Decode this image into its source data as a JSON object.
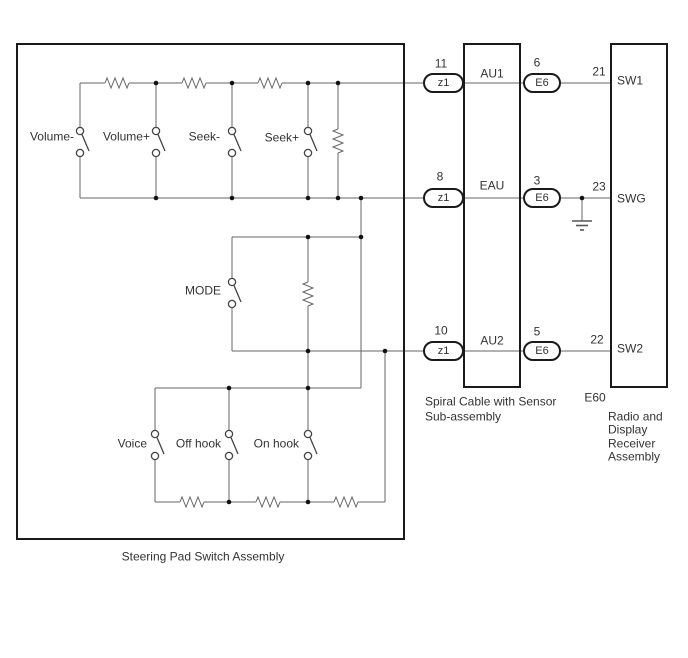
{
  "colors": {
    "background": "#ffffff",
    "wire": "#666666",
    "outline": "#1a1a1a",
    "text": "#333333"
  },
  "steering_pad_assembly": {
    "label": "Steering Pad Switch Assembly",
    "switches": {
      "volume_minus": "Volume-",
      "volume_plus": "Volume+",
      "seek_minus": "Seek-",
      "seek_plus": "Seek+",
      "mode": "MODE",
      "voice": "Voice",
      "off_hook": "Off hook",
      "on_hook": "On hook"
    }
  },
  "spiral_cable_assembly": {
    "label_line1": "Spiral Cable with Sensor",
    "label_line2": "Sub-assembly"
  },
  "radio_assembly": {
    "connector_id": "E60",
    "label_line1": "Radio and",
    "label_line2": "Display",
    "label_line3": "Receiver",
    "label_line4": "Assembly"
  },
  "rows": [
    {
      "z1_pin": "11",
      "z1": "z1",
      "terminal": "AU1",
      "e6_pin": "6",
      "e6": "E6",
      "radio_pin": "21",
      "radio_terminal": "SW1"
    },
    {
      "z1_pin": "8",
      "z1": "z1",
      "terminal": "EAU",
      "e6_pin": "3",
      "e6": "E6",
      "radio_pin": "23",
      "radio_terminal": "SWG"
    },
    {
      "z1_pin": "10",
      "z1": "z1",
      "terminal": "AU2",
      "e6_pin": "5",
      "e6": "E6",
      "radio_pin": "22",
      "radio_terminal": "SW2"
    }
  ]
}
